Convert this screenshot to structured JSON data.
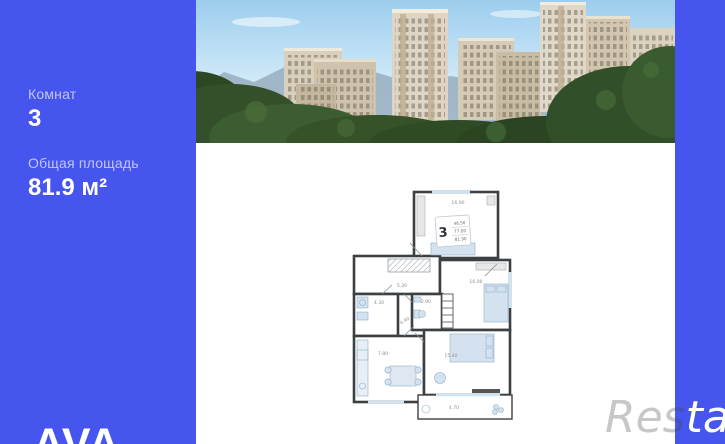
{
  "colors": {
    "background_blue": "#4655ee",
    "panel_white": "#ffffff",
    "wall_dark": "#3d4043",
    "furniture_blue": "#d4e2ef",
    "plan_label_gray": "#8a9097"
  },
  "sidebar": {
    "rooms_label": "Комнат",
    "rooms_value": "3",
    "area_label": "Общая площадь",
    "area_value": "81.9 м²",
    "brand": "AVA"
  },
  "watermark": {
    "part_on_white": "Res",
    "part_on_blue": "tate"
  },
  "floorplan": {
    "stamp": {
      "rooms": "3",
      "values": [
        "48.50",
        "77.00",
        "81.90"
      ]
    },
    "room_areas": {
      "bedroom_top": "16.90",
      "hall": "5.30",
      "bedroom_right": "16.00",
      "bathroom": "4.30",
      "corridor": "4.40",
      "wc": "2.90",
      "kitchen": "7.80",
      "living": "15.40",
      "balcony": "4.70"
    }
  }
}
